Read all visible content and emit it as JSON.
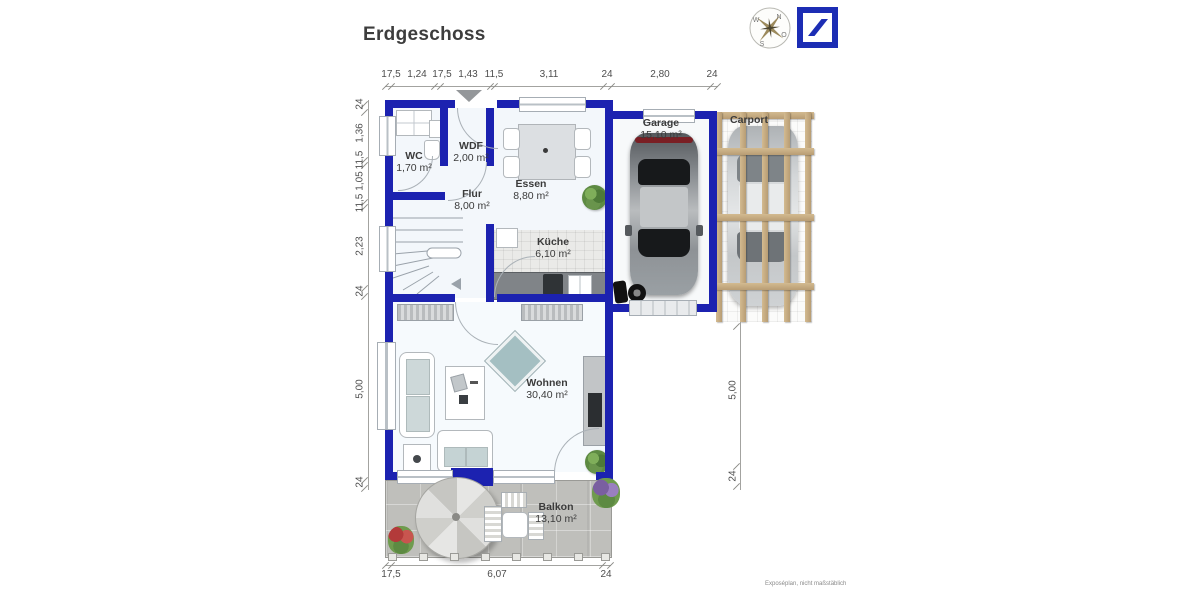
{
  "title": "Erdgeschoss",
  "note": "Exposéplan, nicht maßstäblich",
  "compass": {
    "n": "N",
    "o": "O",
    "s": "S",
    "w": "W"
  },
  "rooms": {
    "wc": {
      "name": "WC",
      "area": "1,70 m²"
    },
    "wdf": {
      "name": "WDF",
      "area": "2,00 m²"
    },
    "essen": {
      "name": "Essen",
      "area": "8,80 m²"
    },
    "flur": {
      "name": "Flur",
      "area": "8,00 m²"
    },
    "kueche": {
      "name": "Küche",
      "area": "6,10 m²"
    },
    "garage": {
      "name": "Garage",
      "area": "15,10 m²"
    },
    "carport": {
      "name": "Carport"
    },
    "wohnen": {
      "name": "Wohnen",
      "area": "30,40 m²"
    },
    "balkon": {
      "name": "Balkon",
      "area": "13,10 m²"
    }
  },
  "dimensions": {
    "top": [
      "17,5",
      "1,24",
      "17,5",
      "1,43",
      "11,5",
      "3,11",
      "24",
      "2,80",
      "24"
    ],
    "left": [
      "24",
      "1,36",
      "11,5",
      "1,05",
      "11,5",
      "2,23",
      "24",
      "5,00",
      "24"
    ],
    "bottom": [
      "17,5",
      "6,07",
      "24"
    ],
    "right": [
      "5,00",
      "24"
    ]
  },
  "colors": {
    "wall_blue": "#1c22b0",
    "logo_blue": "#1c2db4",
    "accent_teal": "#a4bfc2",
    "stone_gray": "#bfbfbb",
    "wood_tan": "#c8ad83"
  }
}
